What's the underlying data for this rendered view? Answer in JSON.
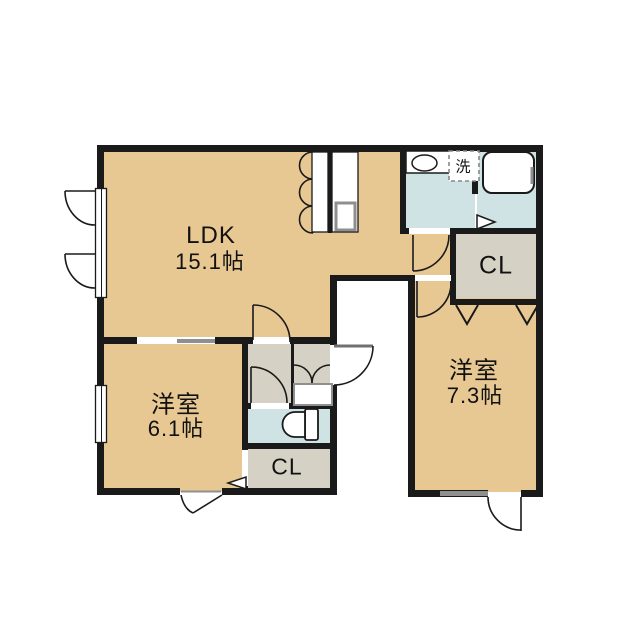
{
  "floorplan": {
    "type": "apartment-floor-plan",
    "rooms": {
      "ldk": {
        "label": "LDK",
        "area": "15.1帖"
      },
      "bedroom_west": {
        "label": "洋室",
        "area": "6.1帖"
      },
      "bedroom_east": {
        "label": "洋室",
        "area": "7.3帖"
      },
      "closet_east": {
        "label": "CL"
      },
      "closet_south": {
        "label": "CL"
      },
      "laundry_space": {
        "label": "洗"
      }
    },
    "fixtures": [
      "kitchen-counter-with-sink",
      "washbasin",
      "bathtub",
      "toilet",
      "shoe-cabinet",
      "washing-machine-space"
    ],
    "colors": {
      "room_tan": "#e8c892",
      "service_gray": "#d5d2c5",
      "wet_area_blue": "#cfe2e4",
      "wall_black": "#1a1a1a",
      "background": "#ffffff",
      "fitting_gray": "#8f8f8f"
    }
  }
}
